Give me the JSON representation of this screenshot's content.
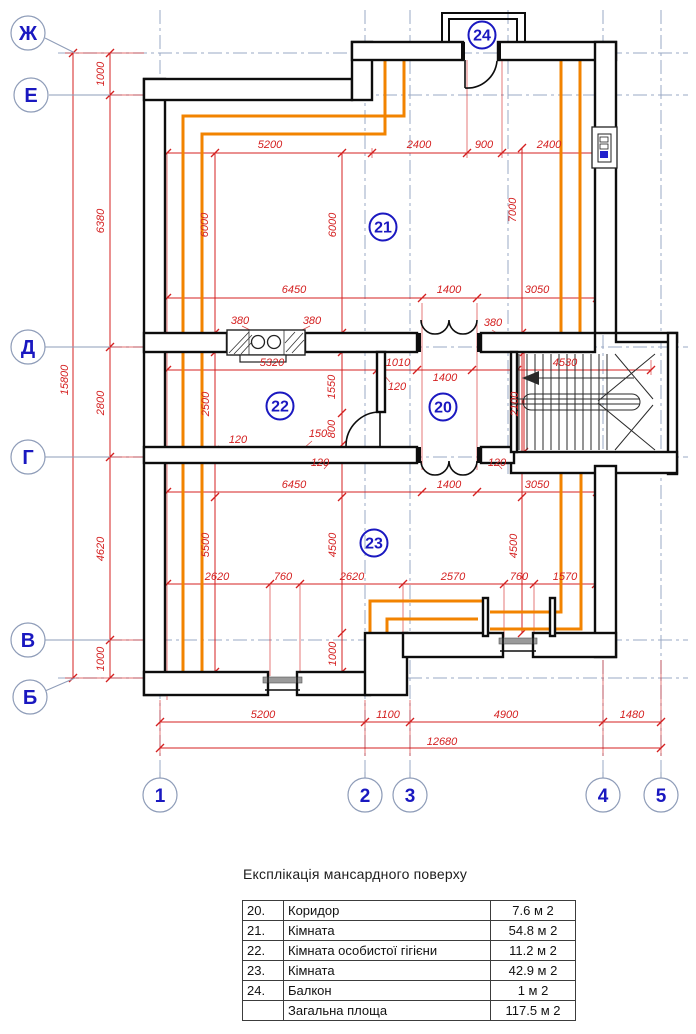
{
  "plan": {
    "axis_rows": [
      {
        "label": "Ж",
        "cx": 28,
        "cy": 33,
        "line_y": 53
      },
      {
        "label": "Е",
        "cx": 31,
        "cy": 95,
        "line_y": 95
      },
      {
        "label": "Д",
        "cx": 28,
        "cy": 347,
        "line_y": 347
      },
      {
        "label": "Г",
        "cx": 28,
        "cy": 457,
        "line_y": 457
      },
      {
        "label": "В",
        "cx": 28,
        "cy": 640,
        "line_y": 640
      },
      {
        "label": "Б",
        "cx": 30,
        "cy": 697,
        "line_y": 678
      }
    ],
    "axis_cols": [
      {
        "label": "1",
        "cx": 160,
        "cy": 795,
        "line_x": 160
      },
      {
        "label": "2",
        "cx": 365,
        "cy": 795,
        "line_x": 365
      },
      {
        "label": "3",
        "cx": 410,
        "cy": 795,
        "line_x": 410
      },
      {
        "label": "4",
        "cx": 603,
        "cy": 795,
        "line_x": 603
      },
      {
        "label": "5",
        "cx": 661,
        "cy": 795,
        "line_x": 661
      }
    ],
    "extra_grid_x": [
      508
    ],
    "room_circles": [
      {
        "label": "20",
        "x": 443,
        "y": 407
      },
      {
        "label": "21",
        "x": 383,
        "y": 227
      },
      {
        "label": "22",
        "x": 280,
        "y": 406
      },
      {
        "label": "23",
        "x": 374,
        "y": 543
      },
      {
        "label": "24",
        "x": 482,
        "y": 35
      }
    ],
    "dim_labels": [
      {
        "t": "5200",
        "x": 270,
        "y": 148,
        "rot": false
      },
      {
        "t": "2400",
        "x": 419,
        "y": 148,
        "rot": false
      },
      {
        "t": "900",
        "x": 484,
        "y": 148,
        "rot": false
      },
      {
        "t": "2400",
        "x": 549,
        "y": 148,
        "rot": false
      },
      {
        "t": "1000",
        "x": 104,
        "y": 74,
        "rot": true
      },
      {
        "t": "6380",
        "x": 104,
        "y": 221,
        "rot": true
      },
      {
        "t": "15800",
        "x": 68,
        "y": 380,
        "rot": true
      },
      {
        "t": "2800",
        "x": 104,
        "y": 403,
        "rot": true
      },
      {
        "t": "4620",
        "x": 104,
        "y": 549,
        "rot": true
      },
      {
        "t": "1000",
        "x": 104,
        "y": 659,
        "rot": true
      },
      {
        "t": "6000",
        "x": 208,
        "y": 225,
        "rot": true
      },
      {
        "t": "6000",
        "x": 336,
        "y": 225,
        "rot": true
      },
      {
        "t": "7000",
        "x": 516,
        "y": 210,
        "rot": true
      },
      {
        "t": "6450",
        "x": 294,
        "y": 293,
        "rot": false
      },
      {
        "t": "1400",
        "x": 449,
        "y": 293,
        "rot": false
      },
      {
        "t": "3050",
        "x": 537,
        "y": 293,
        "rot": false
      },
      {
        "t": "380",
        "x": 240,
        "y": 324,
        "rot": false
      },
      {
        "t": "380",
        "x": 312,
        "y": 324,
        "rot": false
      },
      {
        "t": "380",
        "x": 493,
        "y": 326,
        "rot": false
      },
      {
        "t": "5320",
        "x": 272,
        "y": 366,
        "rot": false
      },
      {
        "t": "1010",
        "x": 398,
        "y": 366,
        "rot": false
      },
      {
        "t": "1400",
        "x": 445,
        "y": 381,
        "rot": false
      },
      {
        "t": "4530",
        "x": 565,
        "y": 366,
        "rot": false
      },
      {
        "t": "120",
        "x": 397,
        "y": 390,
        "rot": false
      },
      {
        "t": "1550",
        "x": 335,
        "y": 387,
        "rot": true
      },
      {
        "t": "2500",
        "x": 209,
        "y": 404,
        "rot": true
      },
      {
        "t": "2100",
        "x": 518,
        "y": 404,
        "rot": true
      },
      {
        "t": "800",
        "x": 335,
        "y": 429,
        "rot": true
      },
      {
        "t": "150",
        "x": 318,
        "y": 437,
        "rot": false
      },
      {
        "t": "120",
        "x": 238,
        "y": 443,
        "rot": false
      },
      {
        "t": "120",
        "x": 320,
        "y": 466,
        "rot": false
      },
      {
        "t": "120",
        "x": 497,
        "y": 466,
        "rot": false
      },
      {
        "t": "6450",
        "x": 294,
        "y": 488,
        "rot": false
      },
      {
        "t": "1400",
        "x": 449,
        "y": 488,
        "rot": false
      },
      {
        "t": "3050",
        "x": 537,
        "y": 488,
        "rot": false
      },
      {
        "t": "5500",
        "x": 209,
        "y": 545,
        "rot": true
      },
      {
        "t": "4500",
        "x": 336,
        "y": 545,
        "rot": true
      },
      {
        "t": "4500",
        "x": 517,
        "y": 546,
        "rot": true
      },
      {
        "t": "1000",
        "x": 336,
        "y": 654,
        "rot": true
      },
      {
        "t": "2620",
        "x": 217,
        "y": 580,
        "rot": false
      },
      {
        "t": "760",
        "x": 283,
        "y": 580,
        "rot": false
      },
      {
        "t": "2620",
        "x": 352,
        "y": 580,
        "rot": false
      },
      {
        "t": "2570",
        "x": 453,
        "y": 580,
        "rot": false
      },
      {
        "t": "760",
        "x": 519,
        "y": 580,
        "rot": false
      },
      {
        "t": "1570",
        "x": 565,
        "y": 580,
        "rot": false
      },
      {
        "t": "5200",
        "x": 263,
        "y": 718,
        "rot": false
      },
      {
        "t": "1100",
        "x": 388,
        "y": 718,
        "rot": false
      },
      {
        "t": "4900",
        "x": 506,
        "y": 718,
        "rot": false
      },
      {
        "t": "1480",
        "x": 632,
        "y": 718,
        "rot": false
      },
      {
        "t": "12680",
        "x": 442,
        "y": 745,
        "rot": false
      }
    ]
  },
  "legend": {
    "title": "Експлікація мансардного поверху",
    "rows": [
      {
        "num": "20.",
        "name": "Коридор",
        "area": "7.6 м 2"
      },
      {
        "num": "21.",
        "name": "Кімната",
        "area": "54.8 м 2"
      },
      {
        "num": "22.",
        "name": "Кімната особистої гігієни",
        "area": "11.2 м 2"
      },
      {
        "num": "23.",
        "name": "Кімната",
        "area": "42.9 м 2"
      },
      {
        "num": "24.",
        "name": "Балкон",
        "area": "1 м 2"
      },
      {
        "num": "",
        "name": "Загальна площа",
        "area": "117.5 м 2"
      }
    ]
  },
  "colors": {
    "wall": "#0d0d0d",
    "dimension": "#d42020",
    "heating": "#f28300",
    "axis_text": "#1a18c0",
    "grid": "#9aa8c4"
  }
}
